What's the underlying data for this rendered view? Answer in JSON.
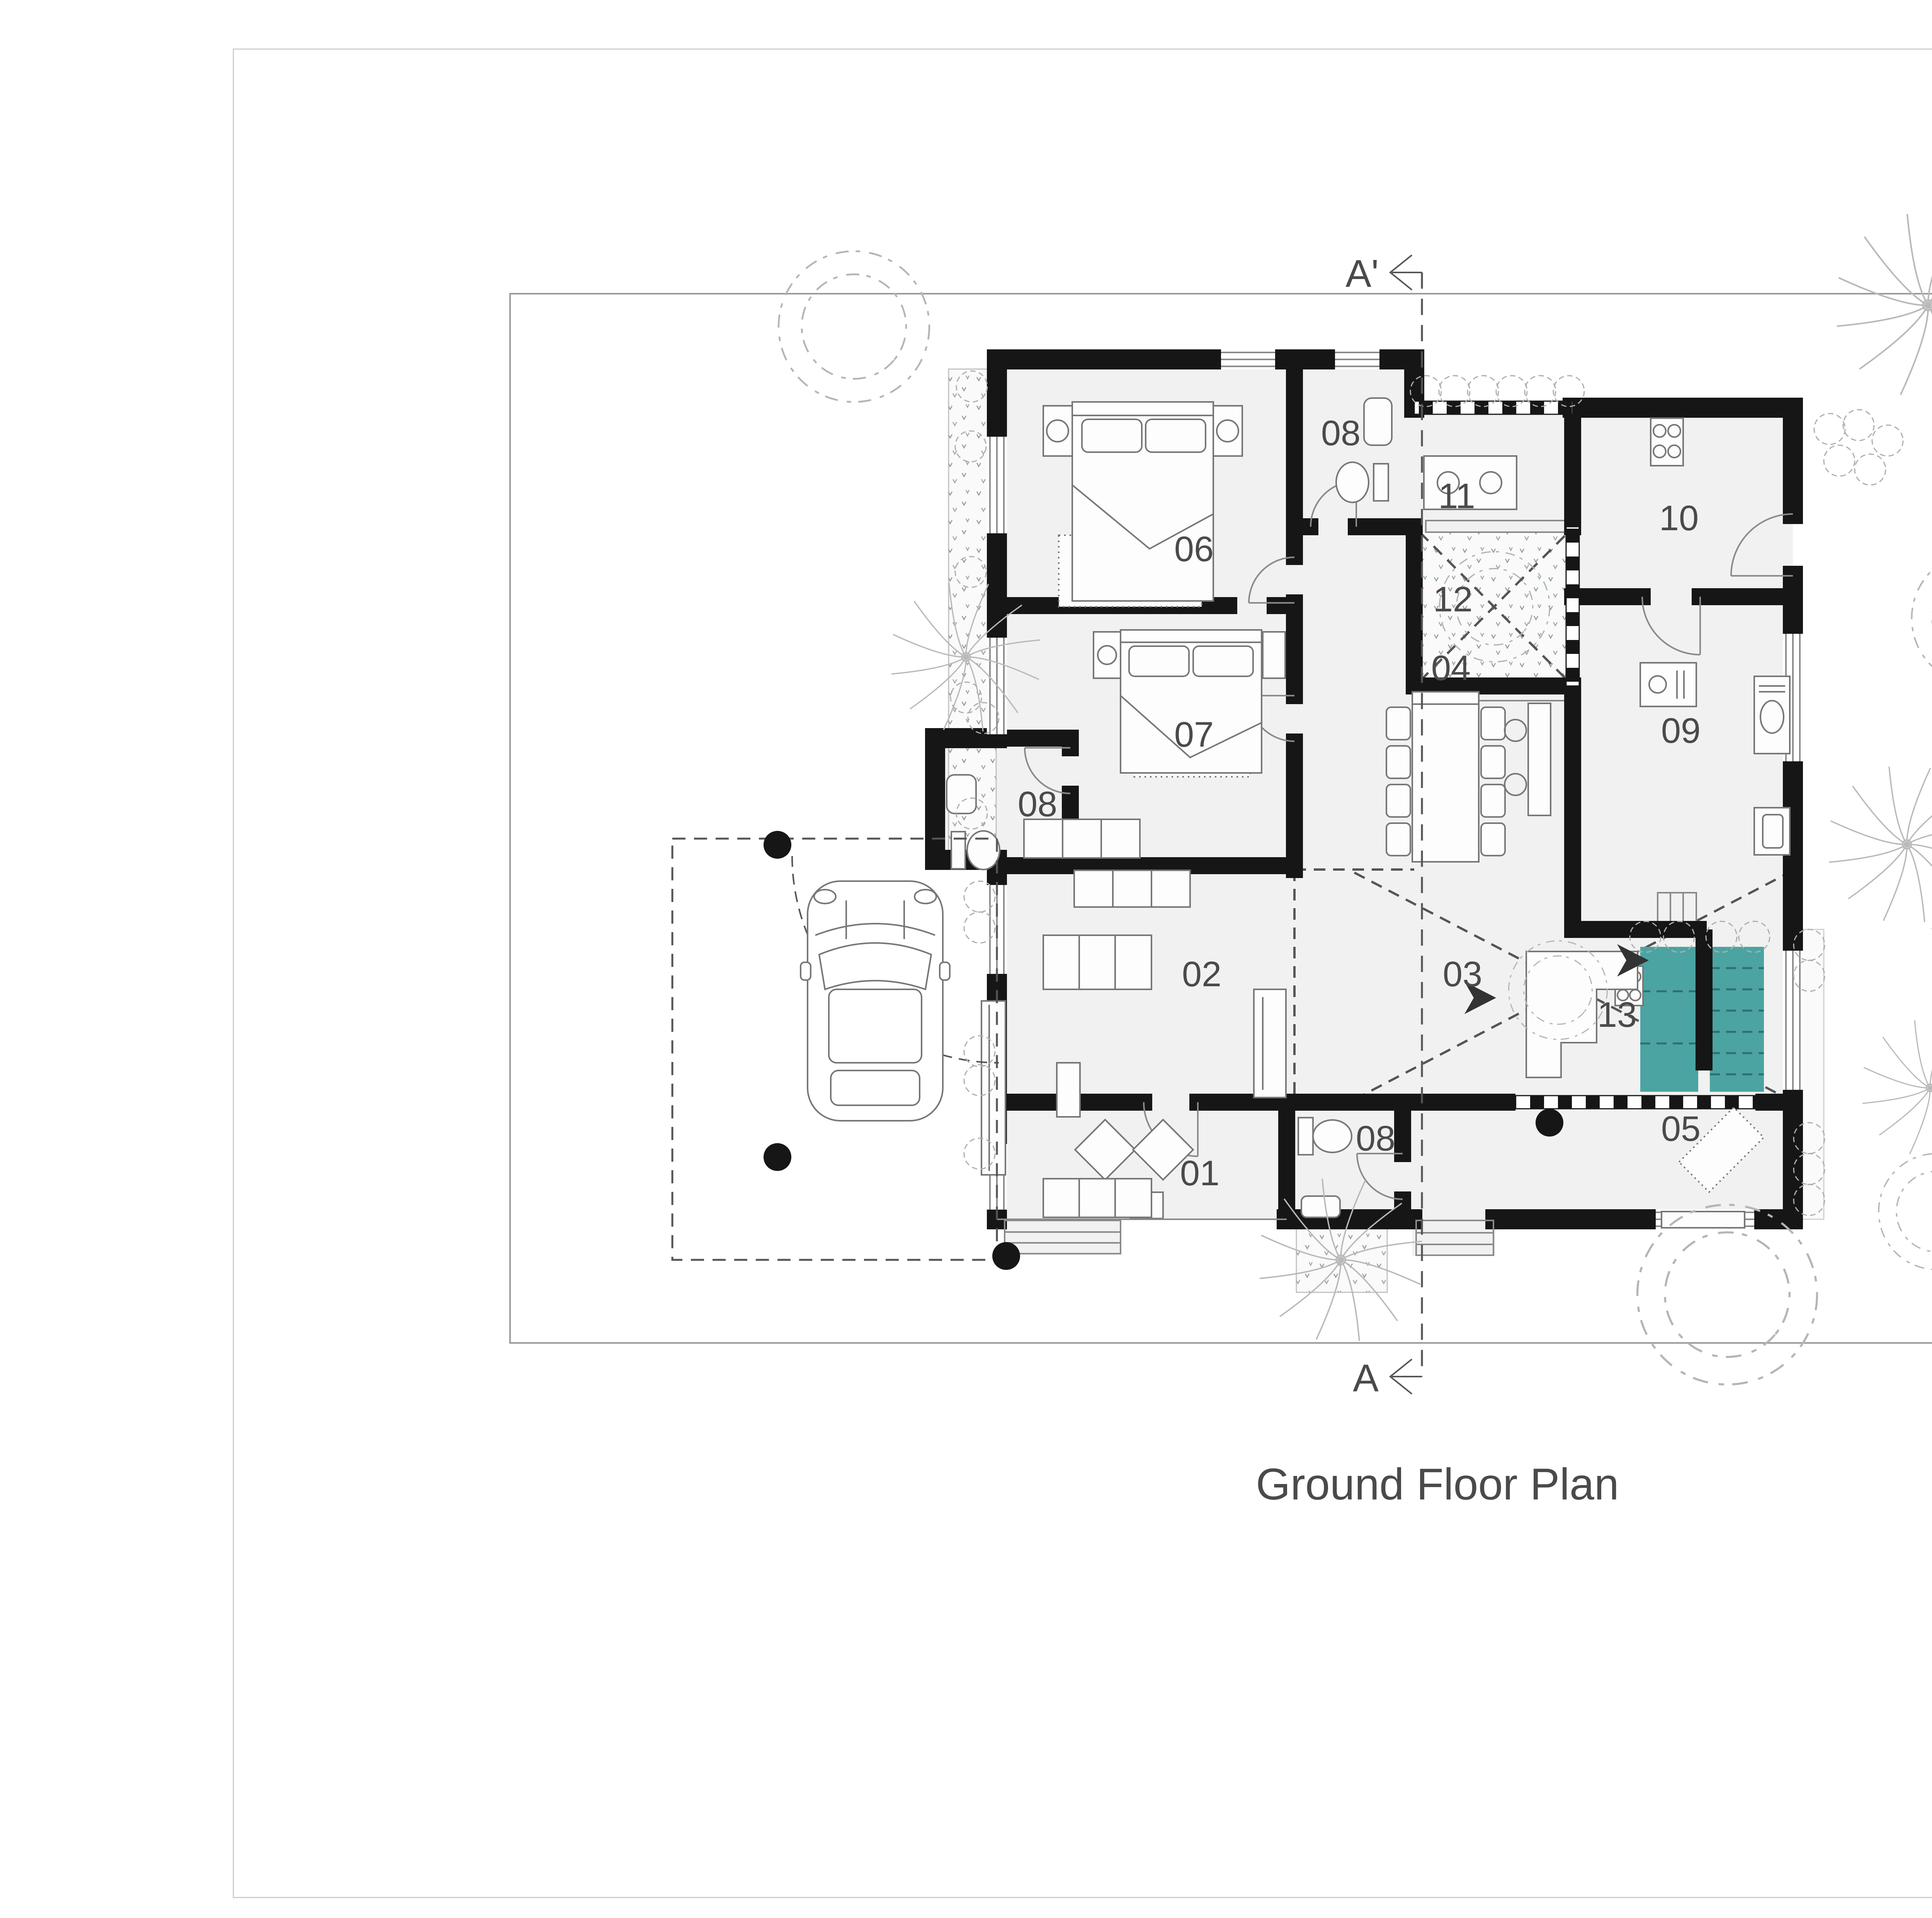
{
  "title": "Ground Floor Plan",
  "colors": {
    "wall": "#161616",
    "floor": "#f1f1f1",
    "stair_accent": "#4ba4a2",
    "text": "#4a4a4a",
    "legend_bg": "#f3f3f3"
  },
  "legend": {
    "title": "LEGEND",
    "items": [
      {
        "code": "01",
        "label": "Sit out"
      },
      {
        "code": "02",
        "label": "Living room"
      },
      {
        "code": "03",
        "label": "Informal Living"
      },
      {
        "code": "04",
        "label": "Dining"
      },
      {
        "code": "05",
        "label": "Prayer"
      },
      {
        "code": "06",
        "label": "M.Bedroom"
      },
      {
        "code": "07",
        "label": "Bedroom"
      },
      {
        "code": "08",
        "label": "Washroom"
      },
      {
        "code": "09",
        "label": "Kitchen"
      },
      {
        "code": "10",
        "label": "Work area"
      },
      {
        "code": "11",
        "label": "Back Sit out"
      },
      {
        "code": "12",
        "label": "Courtyard"
      },
      {
        "code": "13",
        "label": "Study space"
      },
      {
        "code": "14",
        "label": "Play area"
      },
      {
        "code": "15",
        "label": "Balcony"
      }
    ]
  },
  "plan": {
    "room_numbers": [
      "06",
      "08",
      "11",
      "10",
      "12",
      "07",
      "08",
      "04",
      "09",
      "02",
      "03",
      "13",
      "01",
      "08",
      "05"
    ]
  },
  "section": {
    "top_label": "A'",
    "bottom_label": "A"
  },
  "compass": {
    "label": "N"
  },
  "scale_bar": {
    "labels": [
      "00",
      "01",
      "02",
      "04"
    ]
  }
}
